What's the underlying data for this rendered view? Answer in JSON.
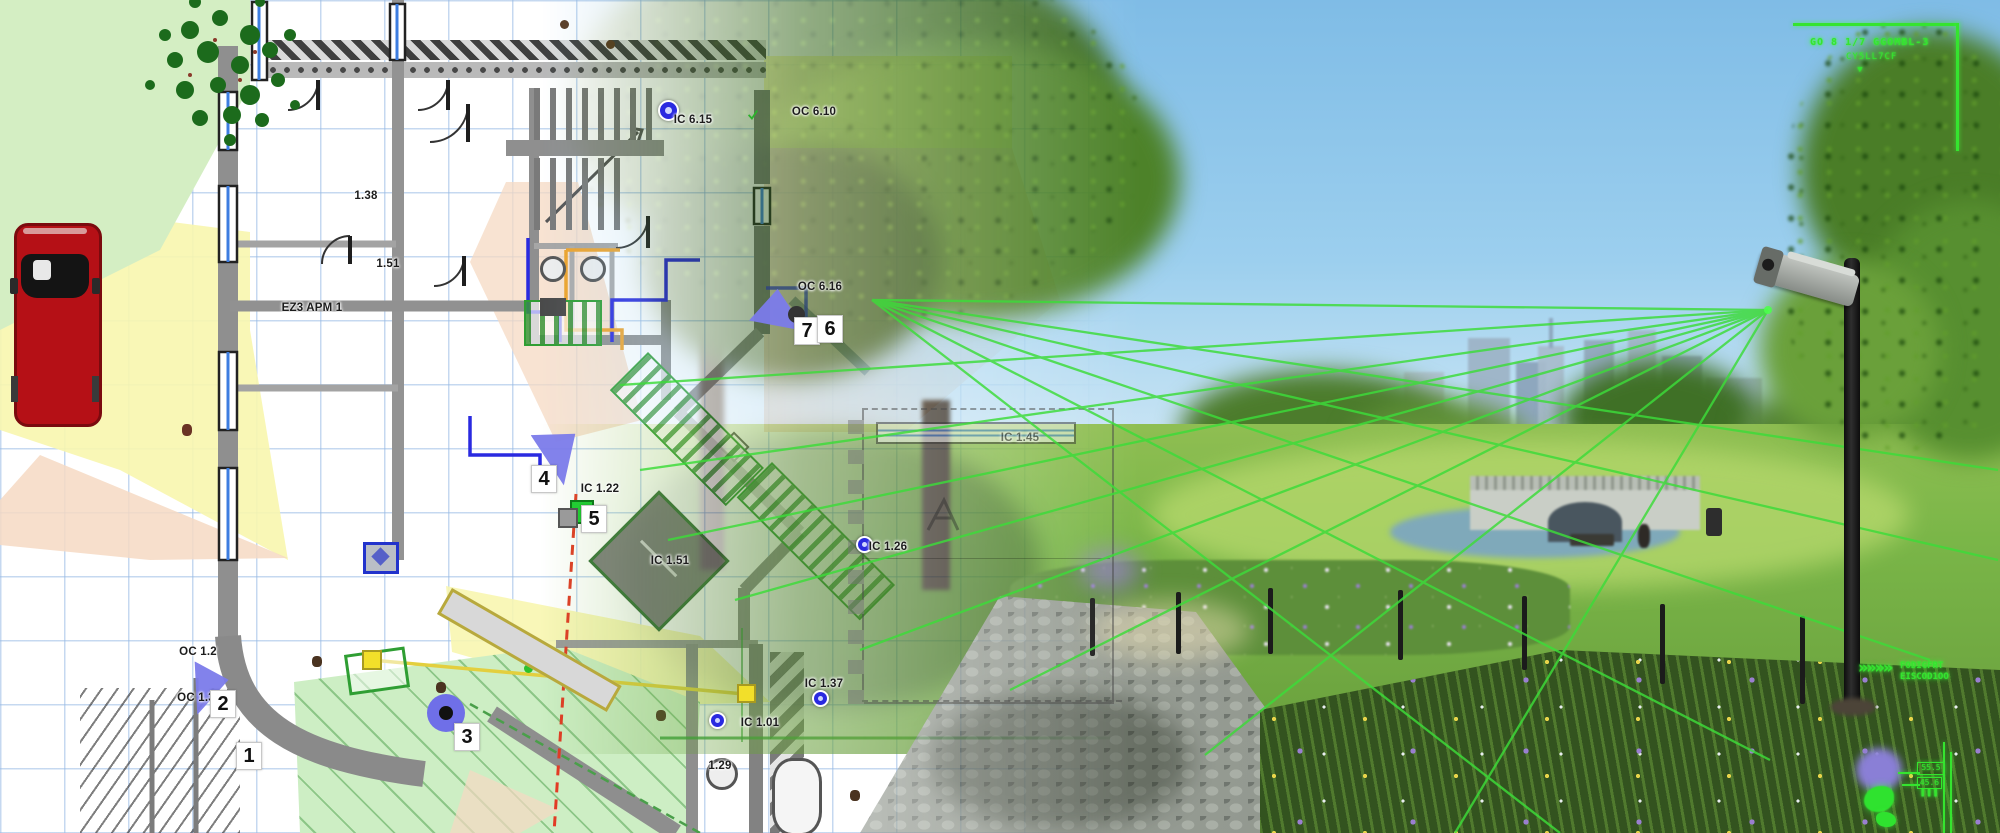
{
  "palette": {
    "plan_grid": "#c9ddf2",
    "zone_green": "#d4eec3",
    "zone_yellow": "#f8f6ae",
    "zone_salmon": "#f6d9c3",
    "wall_gray": "#8c8c8c",
    "wall_dark": "#4a4a4a",
    "cable_blue": "#2a2ae0",
    "cable_orange": "#efa32a",
    "alert_red": "#e23b25",
    "cable_yellow": "#e3cf3e",
    "device_blue": "#7b7bea",
    "plan_green": "#2f9e33",
    "hud_green": "#35e42f",
    "car_red": "#b51016",
    "sky_blue": "#8ec6ea",
    "grass_green": "#7ab648",
    "path_gray": "#8f948d"
  },
  "floor_plan": {
    "room_labels": [
      {
        "text": "IC 6.15",
        "x": 693,
        "y": 120
      },
      {
        "text": "OC 6.10",
        "x": 814,
        "y": 112
      },
      {
        "text": "OC 6.16",
        "x": 820,
        "y": 287
      },
      {
        "text": "1.38",
        "x": 366,
        "y": 196
      },
      {
        "text": "1.51",
        "x": 388,
        "y": 264
      },
      {
        "text": "EZ3 APM 1",
        "x": 312,
        "y": 308
      },
      {
        "text": "IC 1.22",
        "x": 600,
        "y": 489
      },
      {
        "text": "IC 1.51",
        "x": 670,
        "y": 561
      },
      {
        "text": "OC 1.2",
        "x": 198,
        "y": 652
      },
      {
        "text": "OC 1.3",
        "x": 196,
        "y": 698
      },
      {
        "text": "IC 1.37",
        "x": 824,
        "y": 684
      },
      {
        "text": "IC 1.01",
        "x": 760,
        "y": 723
      },
      {
        "text": "1.29",
        "x": 720,
        "y": 766
      },
      {
        "text": "IC 1.26",
        "x": 888,
        "y": 547
      },
      {
        "text": "IC 1.45",
        "x": 1020,
        "y": 438
      }
    ],
    "zone_numbers": [
      {
        "text": "1",
        "x": 249,
        "y": 756
      },
      {
        "text": "2",
        "x": 223,
        "y": 704
      },
      {
        "text": "3",
        "x": 467,
        "y": 737
      },
      {
        "text": "4",
        "x": 544,
        "y": 479
      },
      {
        "text": "5",
        "x": 594,
        "y": 519
      },
      {
        "text": "7",
        "x": 807,
        "y": 331
      },
      {
        "text": "6",
        "x": 830,
        "y": 329
      }
    ]
  },
  "hud": {
    "top_right": {
      "line1": "GO 8 1/7 GGOMBL-3",
      "line2": "CY5LL7CF",
      "pointer": "▾"
    },
    "bottom_right_tag": {
      "chevrons": "»»»»",
      "line1": "FODIGFRT",
      "line2": "EISCOD1OO"
    },
    "mini_panel": {
      "value1": "55.5",
      "value2": "45.6",
      "bars": "❚❚❚"
    }
  }
}
